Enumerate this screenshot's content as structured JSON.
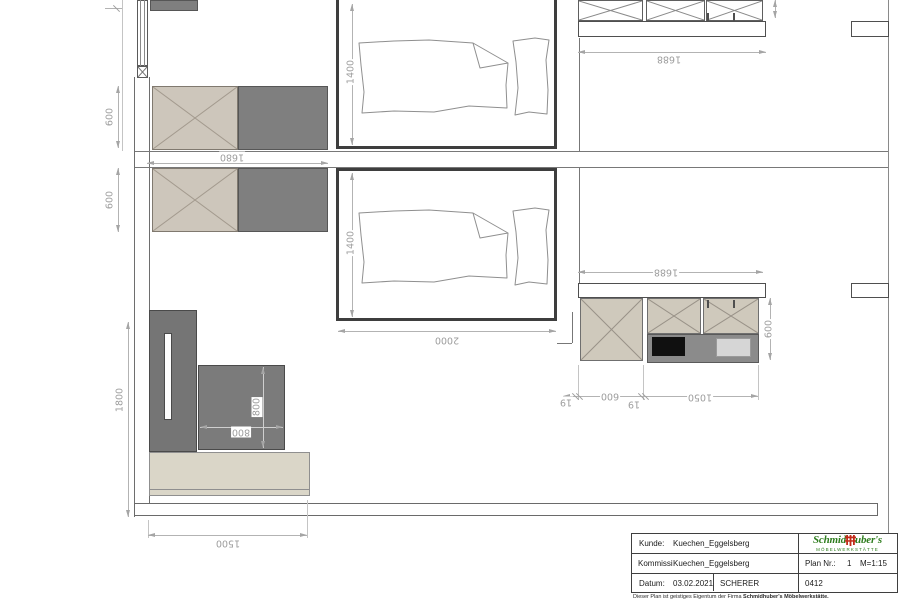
{
  "plan": {
    "dims": {
      "row1_depth": "600",
      "row1_width": "1680",
      "bed1_width": "1400",
      "kitchen_top_width": "1688",
      "row2_depth": "600",
      "bed2_width": "1400",
      "bed2_length": "2000",
      "kitchen_mid_width": "1688",
      "kitchen_mid_depth": "600",
      "niche_gap_left": "19",
      "niche_base": "600",
      "niche_gap_right": "19",
      "niche_counter": "1050",
      "wardrobe_height": "1800",
      "seat_width": "800",
      "seat_depth": "800",
      "podium_width": "1500"
    },
    "colors": {
      "wall": "#3e3e3e",
      "dim": "#9d9d9d",
      "cabinet_beige": "#cdc6bb",
      "cabinet_gray": "#7f7f7f",
      "podium_beige": "#dad6c8",
      "appliance_black": "#101010",
      "appliance_light": "#d6d6d6"
    }
  },
  "title_block": {
    "kunde_label": "Kunde:",
    "kunde_value": "Kuechen_Eggelsberg",
    "kommission_label": "Kommission:",
    "kommission_value": "Kuechen_Eggelsberg",
    "datum_label": "Datum:",
    "datum_value": "03.02.2021",
    "bearbeiter": "SCHERER",
    "plan_label": "Plan Nr.:",
    "plan_number": "1",
    "scale": "M=1:15",
    "commission_number": "0412",
    "disclaimer_plain": "Dieser Plan ist geistiges Eigentum der Firma ",
    "disclaimer_bold": "Schmidhuber's Möbelwerkstätte.",
    "logo": {
      "part1": "Schmid",
      "part2": "uber's",
      "subtitle": "MÖBELWERKSTÄTTE",
      "green": "#2e7d1e",
      "red": "#c22b1a"
    }
  }
}
